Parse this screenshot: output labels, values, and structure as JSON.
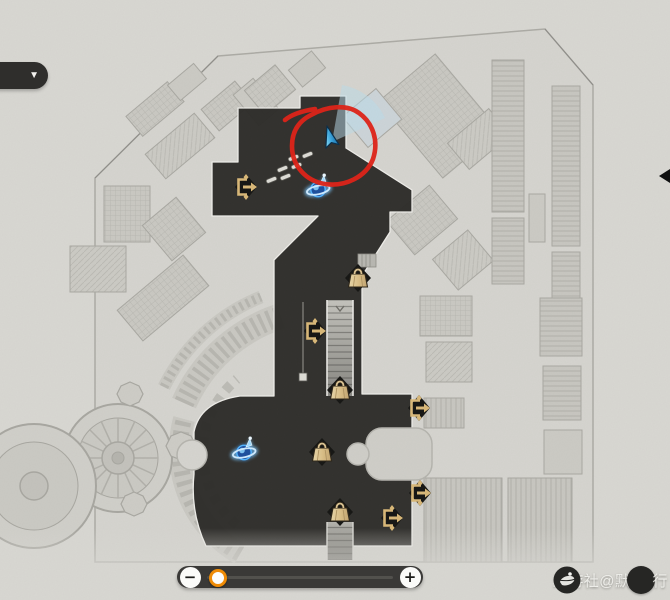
{
  "window": {
    "title": "game-map-screen",
    "width": 670,
    "height": 600
  },
  "toolbar": {
    "collapse_button_glyph": "▼"
  },
  "zoom_control": {
    "decrease_label": "−",
    "increase_label": "+",
    "value": 0.06,
    "accent_color": "#ef8b05"
  },
  "watermark": {
    "prefix": "米游社@默",
    "suffix": "行"
  },
  "map": {
    "player": {
      "x": 331,
      "y": 141,
      "heading": -15
    },
    "annotation": {
      "type": "hand-drawn-circle",
      "cx": 333,
      "cy": 146,
      "color": "#df2318"
    },
    "markers": [
      {
        "type": "exit",
        "label": "exit-passage",
        "x": 246,
        "y": 187
      },
      {
        "type": "anchor",
        "label": "space-anchor",
        "x": 318,
        "y": 189
      },
      {
        "type": "chest",
        "label": "treasure-chest",
        "x": 358,
        "y": 278
      },
      {
        "type": "exit",
        "label": "exit-passage",
        "x": 315,
        "y": 331
      },
      {
        "type": "chest",
        "label": "treasure-chest",
        "x": 340,
        "y": 390
      },
      {
        "type": "exit",
        "label": "exit-passage",
        "x": 419,
        "y": 408
      },
      {
        "type": "chest",
        "label": "treasure-chest",
        "x": 322,
        "y": 452
      },
      {
        "type": "anchor",
        "label": "space-anchor",
        "x": 244,
        "y": 452
      },
      {
        "type": "exit",
        "label": "exit-passage",
        "x": 420,
        "y": 493
      },
      {
        "type": "chest",
        "label": "treasure-chest",
        "x": 340,
        "y": 512
      },
      {
        "type": "exit",
        "label": "exit-passage",
        "x": 392,
        "y": 518
      }
    ]
  },
  "palette": {
    "background": "#d8d7d2",
    "map_fill": "#d5d4cf",
    "building_fill": "#cbcac4",
    "path_fill": "#2d2c29",
    "chest_gold": "#d9bd85",
    "anchor_blue": "#4aa6ff",
    "annotation_red": "#df2318",
    "slider_bg": "#3a3937"
  }
}
